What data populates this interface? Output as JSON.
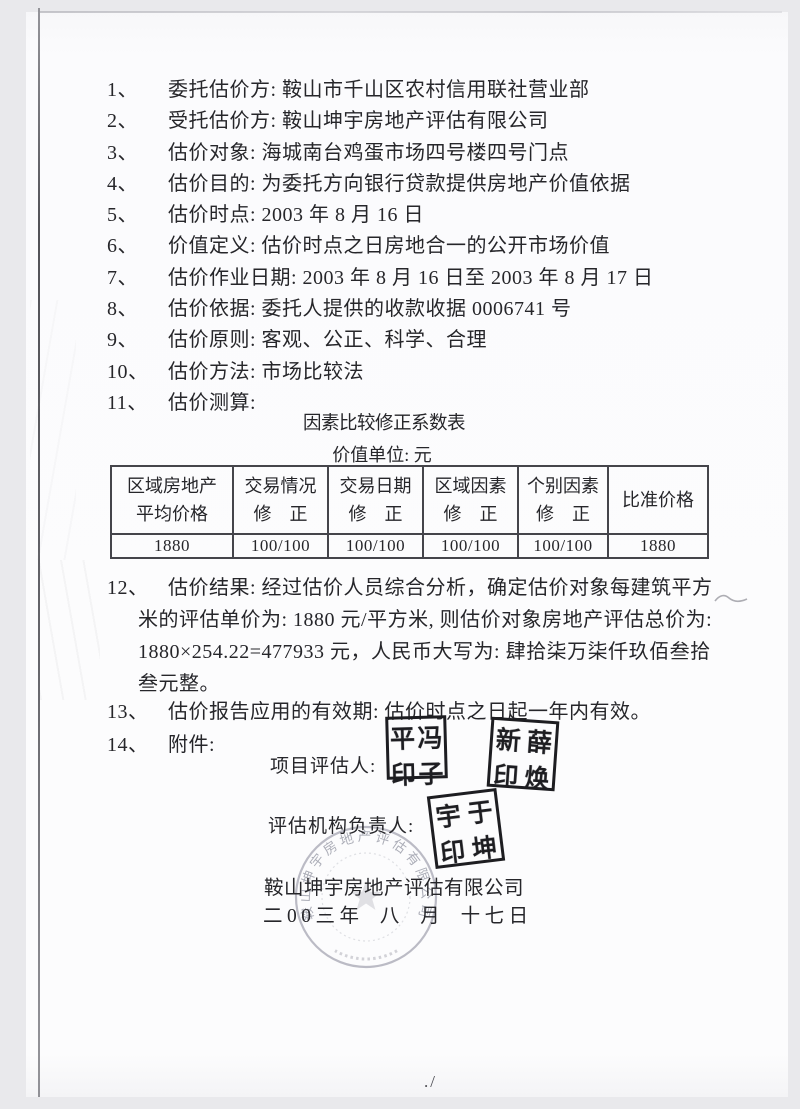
{
  "colors": {
    "ink": "#26262a",
    "seal_ink": "#1d1d21",
    "round_stamp_gray": "#9fa1ac",
    "paper": "#fbfbfd",
    "scanner_background": "#e9e9ec"
  },
  "items": [
    {
      "num": "1、",
      "text": "委托估价方: 鞍山市千山区农村信用联社营业部"
    },
    {
      "num": "2、",
      "text": "受托估价方: 鞍山坤宇房地产评估有限公司"
    },
    {
      "num": "3、",
      "text": "估价对象: 海城南台鸡蛋市场四号楼四号门点"
    },
    {
      "num": "4、",
      "text": "估价目的: 为委托方向银行贷款提供房地产价值依据"
    },
    {
      "num": "5、",
      "text": "估价时点: 2003 年 8 月 16 日"
    },
    {
      "num": "6、",
      "text": "价值定义: 估价时点之日房地合一的公开市场价值"
    },
    {
      "num": "7、",
      "text": "估价作业日期: 2003 年 8 月 16 日至 2003 年 8 月 17 日"
    },
    {
      "num": "8、",
      "text": "估价依据: 委托人提供的收款收据 0006741 号"
    },
    {
      "num": "9、",
      "text": "估价原则: 客观、公正、科学、合理"
    },
    {
      "num": "10、",
      "text": "估价方法: 市场比较法"
    },
    {
      "num": "11、",
      "text": "估价测算:"
    }
  ],
  "table": {
    "title": "因素比较修正系数表",
    "subtitle": "价值单位: 元",
    "headers": [
      [
        "区域房地产",
        "平均价格"
      ],
      [
        "交易情况",
        "修　正"
      ],
      [
        "交易日期",
        "修　正"
      ],
      [
        "区域因素",
        "修　正"
      ],
      [
        "个别因素",
        "修　正"
      ],
      [
        "比准价格"
      ]
    ],
    "row": [
      "1880",
      "100/100",
      "100/100",
      "100/100",
      "100/100",
      "1880"
    ]
  },
  "item12": {
    "num": "12、",
    "lines": [
      "估价结果: 经过估价人员综合分析，确定估价对象每建筑平方",
      "米的评估单价为: 1880 元/平方米, 则估价对象房地产评估总价为:",
      "1880×254.22=477933 元，人民币大写为: 肆拾柒万柒仟玖佰叁拾",
      "叁元整。"
    ]
  },
  "item13": {
    "num": "13、",
    "text": "估价报告应用的有效期: 估价时点之日起一年内有效。"
  },
  "item14": {
    "num": "14、",
    "text": "附件:"
  },
  "signatures": {
    "appraisers_label": "项目评估人:",
    "agency_label": "评估机构负责人:",
    "seal1": [
      "平",
      "冯",
      "印",
      "子"
    ],
    "seal2": [
      "新",
      "薛",
      "印",
      "焕"
    ],
    "seal3": [
      "宇",
      "于",
      "印",
      "坤"
    ],
    "company": "鞍山坤宇房地产评估有限公司",
    "date": "二00三年 八 月 十七日",
    "round_stamp_text": "鞍山坤宇房地产评估有限公司"
  },
  "footer_mark": "./"
}
